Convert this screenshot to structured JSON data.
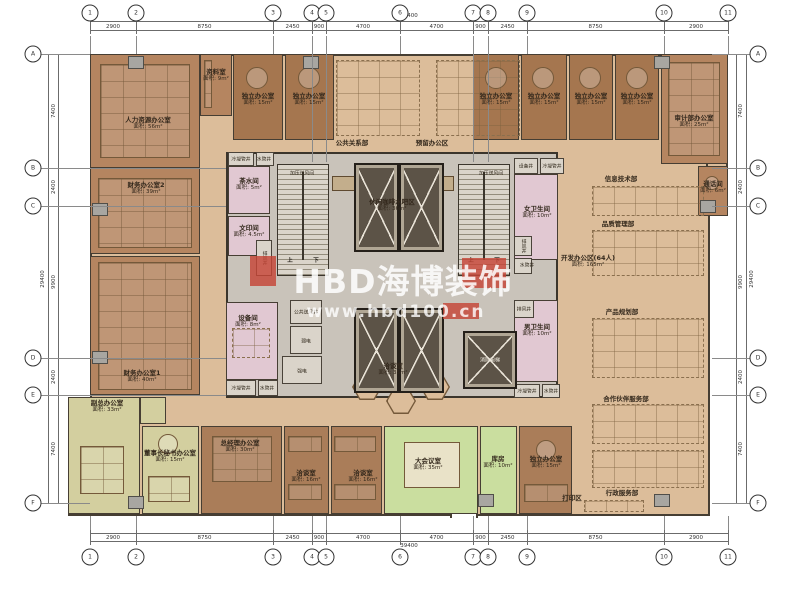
{
  "watermark": {
    "title": "HBD海博装饰",
    "url": "www.hbd100.cn"
  },
  "dimensions": {
    "top": {
      "overall": "39400",
      "segments": [
        "2900",
        "8750",
        "2450",
        "900",
        "4700",
        "4700",
        "900",
        "2450",
        "8750",
        "2900"
      ]
    },
    "bottom": {
      "overall": "39400",
      "segments": [
        "2900",
        "8750",
        "2450",
        "900",
        "4700",
        "4700",
        "900",
        "2450",
        "8750",
        "2900"
      ]
    },
    "left": {
      "overall": "29400",
      "segments": [
        "7400",
        "2400",
        "9900",
        "2400",
        "7400"
      ]
    },
    "right": {
      "overall": "29400",
      "segments": [
        "7400",
        "2400",
        "9900",
        "2400",
        "7400"
      ]
    }
  },
  "grid": {
    "x": [
      90,
      136,
      273,
      312,
      326,
      400,
      473,
      488,
      527,
      664,
      728
    ],
    "y": [
      54,
      168,
      206,
      358,
      395,
      503
    ],
    "top_labels": [
      "1",
      "2",
      "3",
      "4",
      "5",
      "6",
      "7",
      "8",
      "9",
      "10",
      "11"
    ],
    "bottom_labels": [
      "1",
      "2",
      "3",
      "4",
      "5",
      "6",
      "7",
      "8",
      "9",
      "10",
      "11"
    ],
    "left_labels": [
      "A",
      "B",
      "C",
      "D",
      "E",
      "F"
    ],
    "right_labels": [
      "A",
      "B",
      "C",
      "D",
      "E",
      "F"
    ],
    "pair_indices": [
      3,
      4,
      6,
      7
    ]
  },
  "plan": {
    "outline": [
      {
        "x": 90,
        "y": 54,
        "w": 620,
        "h": 462
      },
      {
        "x": 706,
        "y": 54,
        "w": 22,
        "h": 162
      },
      {
        "x": 68,
        "y": 397,
        "w": 24,
        "h": 119
      }
    ],
    "notch": {
      "x": 450,
      "y": 504,
      "w": 28,
      "h": 14
    },
    "core": {
      "x": 226,
      "y": 152,
      "w": 332,
      "h": 246
    },
    "rooms": [
      {
        "n": "人力资源办公室",
        "a": "面积: 56m²",
        "x": 90,
        "y": 54,
        "w": 110,
        "h": 114,
        "c": "b1",
        "lx": 148,
        "ly": 124
      },
      {
        "n": "资料室",
        "a": "面积: 9m²",
        "x": 200,
        "y": 54,
        "w": 32,
        "h": 62,
        "c": "b1",
        "lx": 216,
        "ly": 76
      },
      {
        "n": "独立办公室",
        "a": "面积: 15m²",
        "x": 233,
        "y": 54,
        "w": 50,
        "h": 86,
        "c": "b2",
        "lx": 258,
        "ly": 100
      },
      {
        "n": "独立办公室",
        "a": "面积: 15m²",
        "x": 285,
        "y": 54,
        "w": 49,
        "h": 86,
        "c": "b2",
        "lx": 309,
        "ly": 100
      },
      {
        "n": "独立办公室",
        "a": "面积: 15m²",
        "x": 473,
        "y": 54,
        "w": 46,
        "h": 86,
        "c": "b2",
        "lx": 496,
        "ly": 100
      },
      {
        "n": "独立办公室",
        "a": "面积: 15m²",
        "x": 521,
        "y": 54,
        "w": 46,
        "h": 86,
        "c": "b2",
        "lx": 544,
        "ly": 100
      },
      {
        "n": "独立办公室",
        "a": "面积: 15m²",
        "x": 569,
        "y": 54,
        "w": 44,
        "h": 86,
        "c": "b2",
        "lx": 591,
        "ly": 100
      },
      {
        "n": "独立办公室",
        "a": "面积: 15m²",
        "x": 615,
        "y": 54,
        "w": 44,
        "h": 86,
        "c": "b2",
        "lx": 637,
        "ly": 100
      },
      {
        "n": "审计部办公室",
        "a": "面积: 25m²",
        "x": 661,
        "y": 54,
        "w": 67,
        "h": 110,
        "c": "b1",
        "lx": 694,
        "ly": 122
      },
      {
        "n": "财务办公室2",
        "a": "面积: 39m²",
        "x": 90,
        "y": 168,
        "w": 110,
        "h": 86,
        "c": "b1",
        "lx": 146,
        "ly": 189
      },
      {
        "n": "财务办公室1",
        "a": "面积: 40m²",
        "x": 90,
        "y": 256,
        "w": 110,
        "h": 139,
        "c": "b1",
        "lx": 142,
        "ly": 377
      },
      {
        "n": "副总办公室",
        "a": "面积: 33m²",
        "x": 68,
        "y": 397,
        "w": 72,
        "h": 117,
        "c": "g1",
        "lx": 107,
        "ly": 407
      },
      {
        "n": "",
        "a": "",
        "x": 140,
        "y": 397,
        "w": 26,
        "h": 27,
        "c": "g1",
        "lx": 0,
        "ly": 0
      },
      {
        "n": "董事长秘书办公室",
        "a": "面积: 15m²",
        "x": 142,
        "y": 426,
        "w": 57,
        "h": 88,
        "c": "g1",
        "lx": 170,
        "ly": 457
      },
      {
        "n": "总经理办公室",
        "a": "面积: 30m²",
        "x": 201,
        "y": 426,
        "w": 81,
        "h": 88,
        "c": "b3",
        "lx": 240,
        "ly": 447
      },
      {
        "n": "洽谈室",
        "a": "面积: 16m²",
        "x": 284,
        "y": 426,
        "w": 45,
        "h": 88,
        "c": "b3",
        "lx": 306,
        "ly": 477
      },
      {
        "n": "洽谈室",
        "a": "面积: 16m²",
        "x": 331,
        "y": 426,
        "w": 51,
        "h": 88,
        "c": "b3",
        "lx": 363,
        "ly": 477
      },
      {
        "n": "大会议室",
        "a": "面积: 35m²",
        "x": 384,
        "y": 426,
        "w": 94,
        "h": 88,
        "c": "g2",
        "lx": 428,
        "ly": 465
      },
      {
        "n": "库房",
        "a": "面积: 10m²",
        "x": 480,
        "y": 426,
        "w": 37,
        "h": 88,
        "c": "g2",
        "lx": 498,
        "ly": 463
      },
      {
        "n": "独立办公室",
        "a": "面积: 15m²",
        "x": 519,
        "y": 426,
        "w": 53,
        "h": 88,
        "c": "b3",
        "lx": 546,
        "ly": 463
      },
      {
        "n": "通话间",
        "a": "面积: 6m²",
        "x": 698,
        "y": 166,
        "w": 30,
        "h": 50,
        "c": "b1",
        "lx": 713,
        "ly": 188
      },
      {
        "n": "茶水间",
        "a": "面积: 5m²",
        "x": 228,
        "y": 166,
        "w": 42,
        "h": 48,
        "c": "p1",
        "lx": 249,
        "ly": 185
      },
      {
        "n": "文印间",
        "a": "面积: 4.5m²",
        "x": 228,
        "y": 216,
        "w": 42,
        "h": 40,
        "c": "p1",
        "lx": 249,
        "ly": 232
      },
      {
        "n": "设备间",
        "a": "面积: 8m²",
        "x": 226,
        "y": 302,
        "w": 52,
        "h": 78,
        "c": "p1",
        "lx": 248,
        "ly": 322
      },
      {
        "n": "女卫生间",
        "a": "面积: 10m²",
        "x": 514,
        "y": 174,
        "w": 44,
        "h": 86,
        "c": "p1",
        "lx": 537,
        "ly": 213
      },
      {
        "n": "男卫生间",
        "a": "面积: 10m²",
        "x": 514,
        "y": 300,
        "w": 44,
        "h": 82,
        "c": "p1",
        "lx": 537,
        "ly": 331
      }
    ],
    "service_boxes": [
      {
        "x": 228,
        "y": 152,
        "w": 26,
        "h": 14
      },
      {
        "x": 256,
        "y": 152,
        "w": 18,
        "h": 14
      },
      {
        "x": 256,
        "y": 240,
        "w": 16,
        "h": 36
      },
      {
        "x": 290,
        "y": 300,
        "w": 32,
        "h": 24
      },
      {
        "x": 290,
        "y": 326,
        "w": 32,
        "h": 28
      },
      {
        "x": 282,
        "y": 356,
        "w": 40,
        "h": 28
      },
      {
        "x": 226,
        "y": 380,
        "w": 30,
        "h": 16
      },
      {
        "x": 258,
        "y": 380,
        "w": 20,
        "h": 16
      },
      {
        "x": 514,
        "y": 158,
        "w": 24,
        "h": 16
      },
      {
        "x": 540,
        "y": 158,
        "w": 24,
        "h": 16
      },
      {
        "x": 514,
        "y": 236,
        "w": 18,
        "h": 20
      },
      {
        "x": 514,
        "y": 258,
        "w": 18,
        "h": 16
      },
      {
        "x": 514,
        "y": 300,
        "w": 20,
        "h": 18
      },
      {
        "x": 514,
        "y": 384,
        "w": 26,
        "h": 14
      },
      {
        "x": 542,
        "y": 384,
        "w": 18,
        "h": 14
      }
    ],
    "shaft_labels": [
      {
        "t": "冷凝管井",
        "x": 241,
        "y": 159
      },
      {
        "t": "水管井",
        "x": 264,
        "y": 159
      },
      {
        "t": "加压送风间",
        "x": 302,
        "y": 173
      },
      {
        "t": "排风井",
        "x": 264,
        "y": 258,
        "v": true
      },
      {
        "t": "公共送风井",
        "x": 306,
        "y": 312
      },
      {
        "t": "弱电",
        "x": 306,
        "y": 341
      },
      {
        "t": "强电",
        "x": 302,
        "y": 371
      },
      {
        "t": "冷凝管井",
        "x": 241,
        "y": 388
      },
      {
        "t": "水管井",
        "x": 267,
        "y": 388
      },
      {
        "t": "加压送风间",
        "x": 491,
        "y": 173
      },
      {
        "t": "设备井",
        "x": 526,
        "y": 166
      },
      {
        "t": "冷凝管井",
        "x": 552,
        "y": 166
      },
      {
        "t": "排风井",
        "x": 523,
        "y": 246,
        "v": true
      },
      {
        "t": "水管井",
        "x": 527,
        "y": 265
      },
      {
        "t": "排风井",
        "x": 524,
        "y": 309
      },
      {
        "t": "冷凝管井",
        "x": 527,
        "y": 391
      },
      {
        "t": "水管井",
        "x": 551,
        "y": 391
      },
      {
        "t": "消防电梯",
        "x": 490,
        "y": 360,
        "light": true
      }
    ],
    "area_labels": [
      {
        "n": "公共关系部",
        "x": 352,
        "y": 143
      },
      {
        "n": "预留办公区",
        "x": 432,
        "y": 143
      },
      {
        "n": "休闲咖啡水吧区",
        "a": "面积: 36m²",
        "x": 392,
        "y": 206
      },
      {
        "n": "洽谈室",
        "a": "面积: 35m²",
        "x": 393,
        "y": 370
      },
      {
        "n": "信息技术部",
        "x": 621,
        "y": 179
      },
      {
        "n": "品质管理部",
        "x": 618,
        "y": 224
      },
      {
        "n": "产品规划部",
        "x": 622,
        "y": 312
      },
      {
        "n": "合作伙伴服务部",
        "x": 626,
        "y": 399
      },
      {
        "n": "行政服务部",
        "x": 622,
        "y": 493
      },
      {
        "n": "打印区",
        "x": 572,
        "y": 498
      },
      {
        "n": "开发办公区(64人)",
        "a": "面积: 165m²",
        "x": 588,
        "y": 262
      }
    ],
    "elevators": [
      {
        "x": 354,
        "y": 163,
        "w": 45,
        "h": 89
      },
      {
        "x": 399,
        "y": 163,
        "w": 45,
        "h": 89
      },
      {
        "x": 354,
        "y": 308,
        "w": 45,
        "h": 85
      },
      {
        "x": 399,
        "y": 308,
        "w": 45,
        "h": 85
      },
      {
        "x": 463,
        "y": 331,
        "w": 54,
        "h": 58
      }
    ],
    "stairs": [
      {
        "x": 277,
        "y": 164,
        "w": 52,
        "h": 112,
        "up": "上",
        "dn": "下",
        "ux": 290,
        "uy": 260,
        "dx": 316,
        "dy": 260
      },
      {
        "x": 458,
        "y": 164,
        "w": 52,
        "h": 112,
        "up": "上",
        "dn": "下",
        "ux": 471,
        "uy": 260,
        "dx": 497,
        "dy": 260
      }
    ],
    "columns": [
      [
        128,
        56
      ],
      [
        303,
        56
      ],
      [
        654,
        56
      ],
      [
        700,
        200
      ],
      [
        92,
        203
      ],
      [
        92,
        351
      ],
      [
        128,
        496
      ],
      [
        478,
        494
      ],
      [
        654,
        494
      ]
    ],
    "furniture": [
      {
        "t": "dashed",
        "x": 336,
        "y": 60,
        "w": 84,
        "h": 76
      },
      {
        "t": "dashed",
        "x": 436,
        "y": 60,
        "w": 84,
        "h": 76
      },
      {
        "t": "dashed",
        "x": 592,
        "y": 186,
        "w": 112,
        "h": 30
      },
      {
        "t": "dashed",
        "x": 592,
        "y": 230,
        "w": 112,
        "h": 46
      },
      {
        "t": "dashed",
        "x": 592,
        "y": 318,
        "w": 112,
        "h": 60
      },
      {
        "t": "dashed",
        "x": 592,
        "y": 404,
        "w": 112,
        "h": 40
      },
      {
        "t": "dashed",
        "x": 592,
        "y": 450,
        "w": 112,
        "h": 38
      },
      {
        "t": "dashed",
        "x": 584,
        "y": 500,
        "w": 60,
        "h": 12
      },
      {
        "t": "dashed",
        "x": 232,
        "y": 328,
        "w": 38,
        "h": 30
      },
      {
        "t": "solid",
        "x": 100,
        "y": 64,
        "w": 90,
        "h": 94
      },
      {
        "t": "solid",
        "x": 98,
        "y": 178,
        "w": 94,
        "h": 70
      },
      {
        "t": "solid",
        "x": 98,
        "y": 262,
        "w": 94,
        "h": 128
      },
      {
        "t": "solid",
        "x": 668,
        "y": 62,
        "w": 52,
        "h": 94
      },
      {
        "t": "solid",
        "x": 212,
        "y": 436,
        "w": 60,
        "h": 46
      },
      {
        "t": "solid",
        "x": 80,
        "y": 446,
        "w": 44,
        "h": 48
      },
      {
        "t": "solid",
        "x": 148,
        "y": 476,
        "w": 42,
        "h": 26
      },
      {
        "t": "solid",
        "x": 288,
        "y": 436,
        "w": 34,
        "h": 16
      },
      {
        "t": "solid",
        "x": 288,
        "y": 484,
        "w": 34,
        "h": 16
      },
      {
        "t": "solid",
        "x": 334,
        "y": 436,
        "w": 42,
        "h": 16
      },
      {
        "t": "solid",
        "x": 334,
        "y": 484,
        "w": 42,
        "h": 16
      },
      {
        "t": "solid",
        "x": 524,
        "y": 484,
        "w": 44,
        "h": 18
      },
      {
        "t": "solid",
        "x": 204,
        "y": 60,
        "w": 8,
        "h": 48
      },
      {
        "t": "table",
        "x": 404,
        "y": 442,
        "w": 56,
        "h": 46
      },
      {
        "t": "round",
        "x": 246,
        "y": 67,
        "w": 22,
        "h": 22
      },
      {
        "t": "round",
        "x": 298,
        "y": 67,
        "w": 22,
        "h": 22
      },
      {
        "t": "round",
        "x": 485,
        "y": 67,
        "w": 22,
        "h": 22
      },
      {
        "t": "round",
        "x": 532,
        "y": 67,
        "w": 22,
        "h": 22
      },
      {
        "t": "round",
        "x": 579,
        "y": 67,
        "w": 22,
        "h": 22
      },
      {
        "t": "round",
        "x": 626,
        "y": 67,
        "w": 22,
        "h": 22
      },
      {
        "t": "round",
        "x": 705,
        "y": 176,
        "w": 14,
        "h": 14
      },
      {
        "t": "round",
        "x": 158,
        "y": 434,
        "w": 20,
        "h": 20
      },
      {
        "t": "round",
        "x": 536,
        "y": 440,
        "w": 20,
        "h": 20
      },
      {
        "t": "counter",
        "x": 332,
        "y": 176,
        "w": 122,
        "h": 15
      },
      {
        "t": "hex",
        "x": 352,
        "y": 374,
        "w": 30,
        "h": 26
      },
      {
        "t": "hex",
        "x": 386,
        "y": 388,
        "w": 30,
        "h": 26
      },
      {
        "t": "hex",
        "x": 420,
        "y": 374,
        "w": 30,
        "h": 26
      }
    ]
  }
}
